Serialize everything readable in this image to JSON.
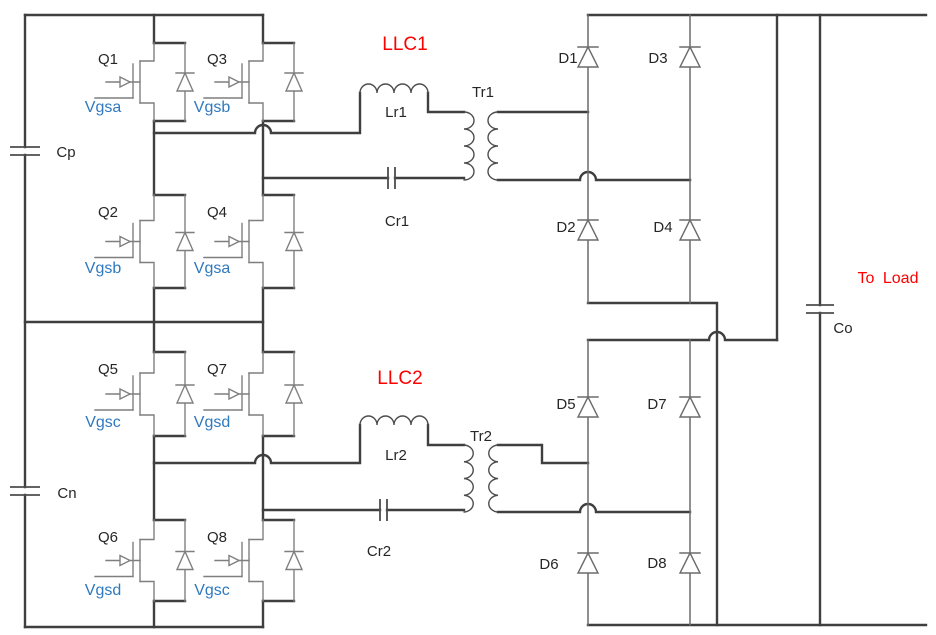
{
  "colors": {
    "background": "#ffffff",
    "wire": "#3f3f3f",
    "symbol": "#7f7f7f",
    "label_dark": "#262626",
    "gate_label_blue": "#2e79bf",
    "accent_red": "#fe0000"
  },
  "input": {
    "cap_positive": "Cp",
    "cap_negative": "Cn"
  },
  "llc1": {
    "title": "LLC1",
    "resonant_inductor": "Lr1",
    "resonant_capacitor": "Cr1",
    "transformer": "Tr1",
    "switches": {
      "q1": {
        "name": "Q1",
        "gate": "Vgsa"
      },
      "q3": {
        "name": "Q3",
        "gate": "Vgsb"
      },
      "q2": {
        "name": "Q2",
        "gate": "Vgsb"
      },
      "q4": {
        "name": "Q4",
        "gate": "Vgsa"
      }
    },
    "rectifier": {
      "d1": "D1",
      "d3": "D3",
      "d2": "D2",
      "d4": "D4"
    }
  },
  "llc2": {
    "title": "LLC2",
    "resonant_inductor": "Lr2",
    "resonant_capacitor": "Cr2",
    "transformer": "Tr2",
    "switches": {
      "q5": {
        "name": "Q5",
        "gate": "Vgsc"
      },
      "q7": {
        "name": "Q7",
        "gate": "Vgsd"
      },
      "q6": {
        "name": "Q6",
        "gate": "Vgsd"
      },
      "q8": {
        "name": "Q8",
        "gate": "Vgsc"
      }
    },
    "rectifier": {
      "d5": "D5",
      "d7": "D7",
      "d6": "D6",
      "d8": "D8"
    }
  },
  "output": {
    "filter_capacitor": "Co",
    "load_label": "To Load"
  }
}
